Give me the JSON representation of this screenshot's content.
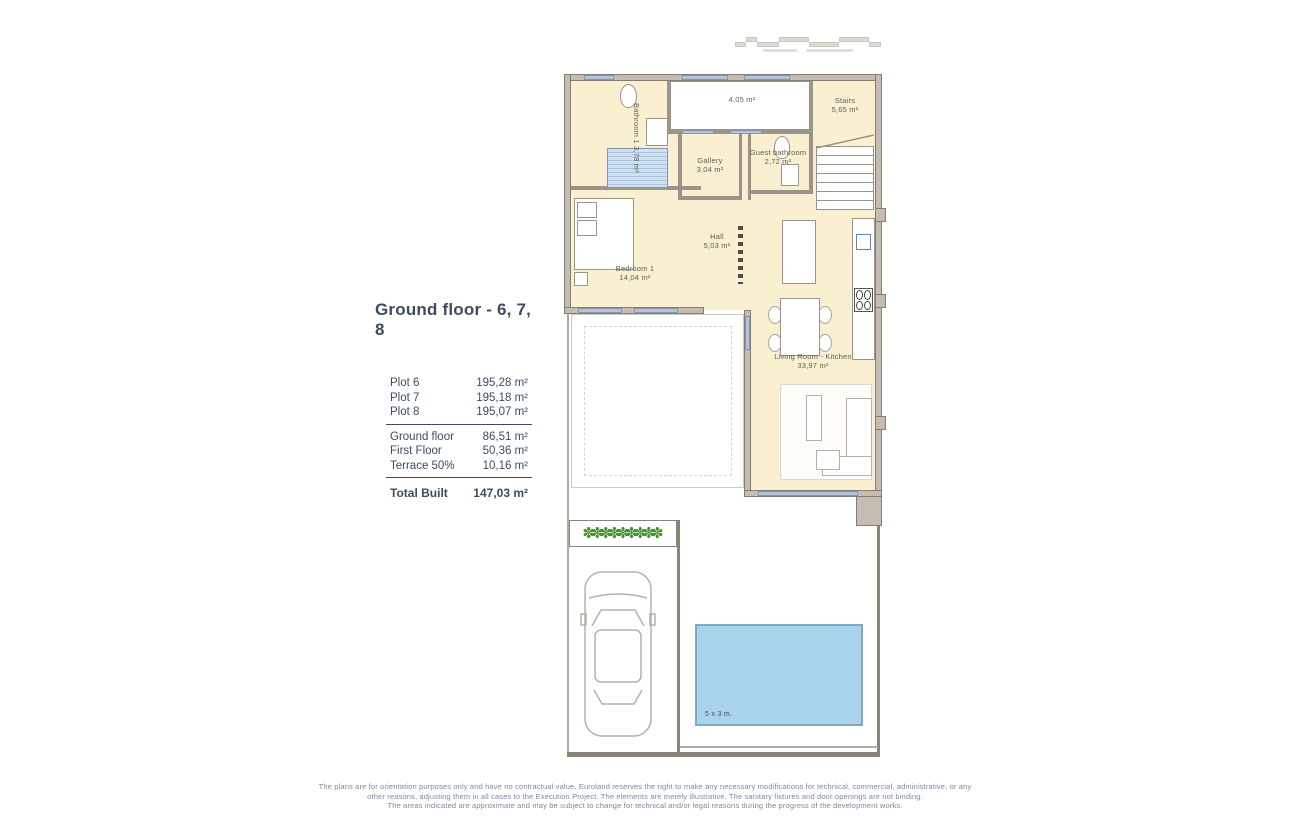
{
  "title": {
    "text": "Ground floor - 6, 7, 8"
  },
  "summary": {
    "plots": [
      {
        "label": "Plot 6",
        "value": "195,28 m²"
      },
      {
        "label": "Plot 7",
        "value": "195,18 m²"
      },
      {
        "label": "Plot 8",
        "value": "195,07 m²"
      }
    ],
    "floors": [
      {
        "label": "Ground floor",
        "value": "86,51 m²"
      },
      {
        "label": "First Floor",
        "value": "50,36 m²"
      },
      {
        "label": "Terrace 50%",
        "value": "10,16 m²"
      }
    ],
    "total": {
      "label": "Total Built",
      "value": "147,03 m²"
    }
  },
  "rooms": {
    "bathroom1": {
      "name": "Bathroom 1",
      "area": "3,78 m²"
    },
    "top_room": {
      "area": "4,05 m²"
    },
    "stairs": {
      "name": "Stairs",
      "area": "5,65 m²"
    },
    "gallery": {
      "name": "Gallery",
      "area": "3,04 m²"
    },
    "guest_bathroom": {
      "name": "Guest bathroom",
      "area": "2,72 m²"
    },
    "hall": {
      "name": "Hall",
      "area": "5,03 m²"
    },
    "bedroom1": {
      "name": "Bedroom 1",
      "area": "14,04 m²"
    },
    "living": {
      "name": "Living Room - Kitchen",
      "area": "33,97 m²"
    }
  },
  "pool": {
    "label": "5 x 3 m."
  },
  "icons": {
    "plant": "✽"
  },
  "disclaimer": {
    "line1": "The plans are for orientation purposes only and have no contractual value. Euroland reserves the right to make any necessary modifications for technical, commercial, administrative, or any",
    "line2": "other reasons, adjusting them in all cases to the Execution Project. The elements are merely illustrative. The sanitary fixtures and door openings are not binding.",
    "line3": "The areas indicated are approximate and may be subject to change for technical and/or legal reasons during the progress of the development works."
  },
  "colors": {
    "accent_navy": "#3d4c63",
    "floor_cream": "#faf0d1",
    "wall_gray": "#c4bdb2",
    "window_blue": "#b6c3db",
    "pool_blue": "#a9d3ec",
    "plant_green": "#459231",
    "disclaimer_gray": "#7b87a2"
  }
}
